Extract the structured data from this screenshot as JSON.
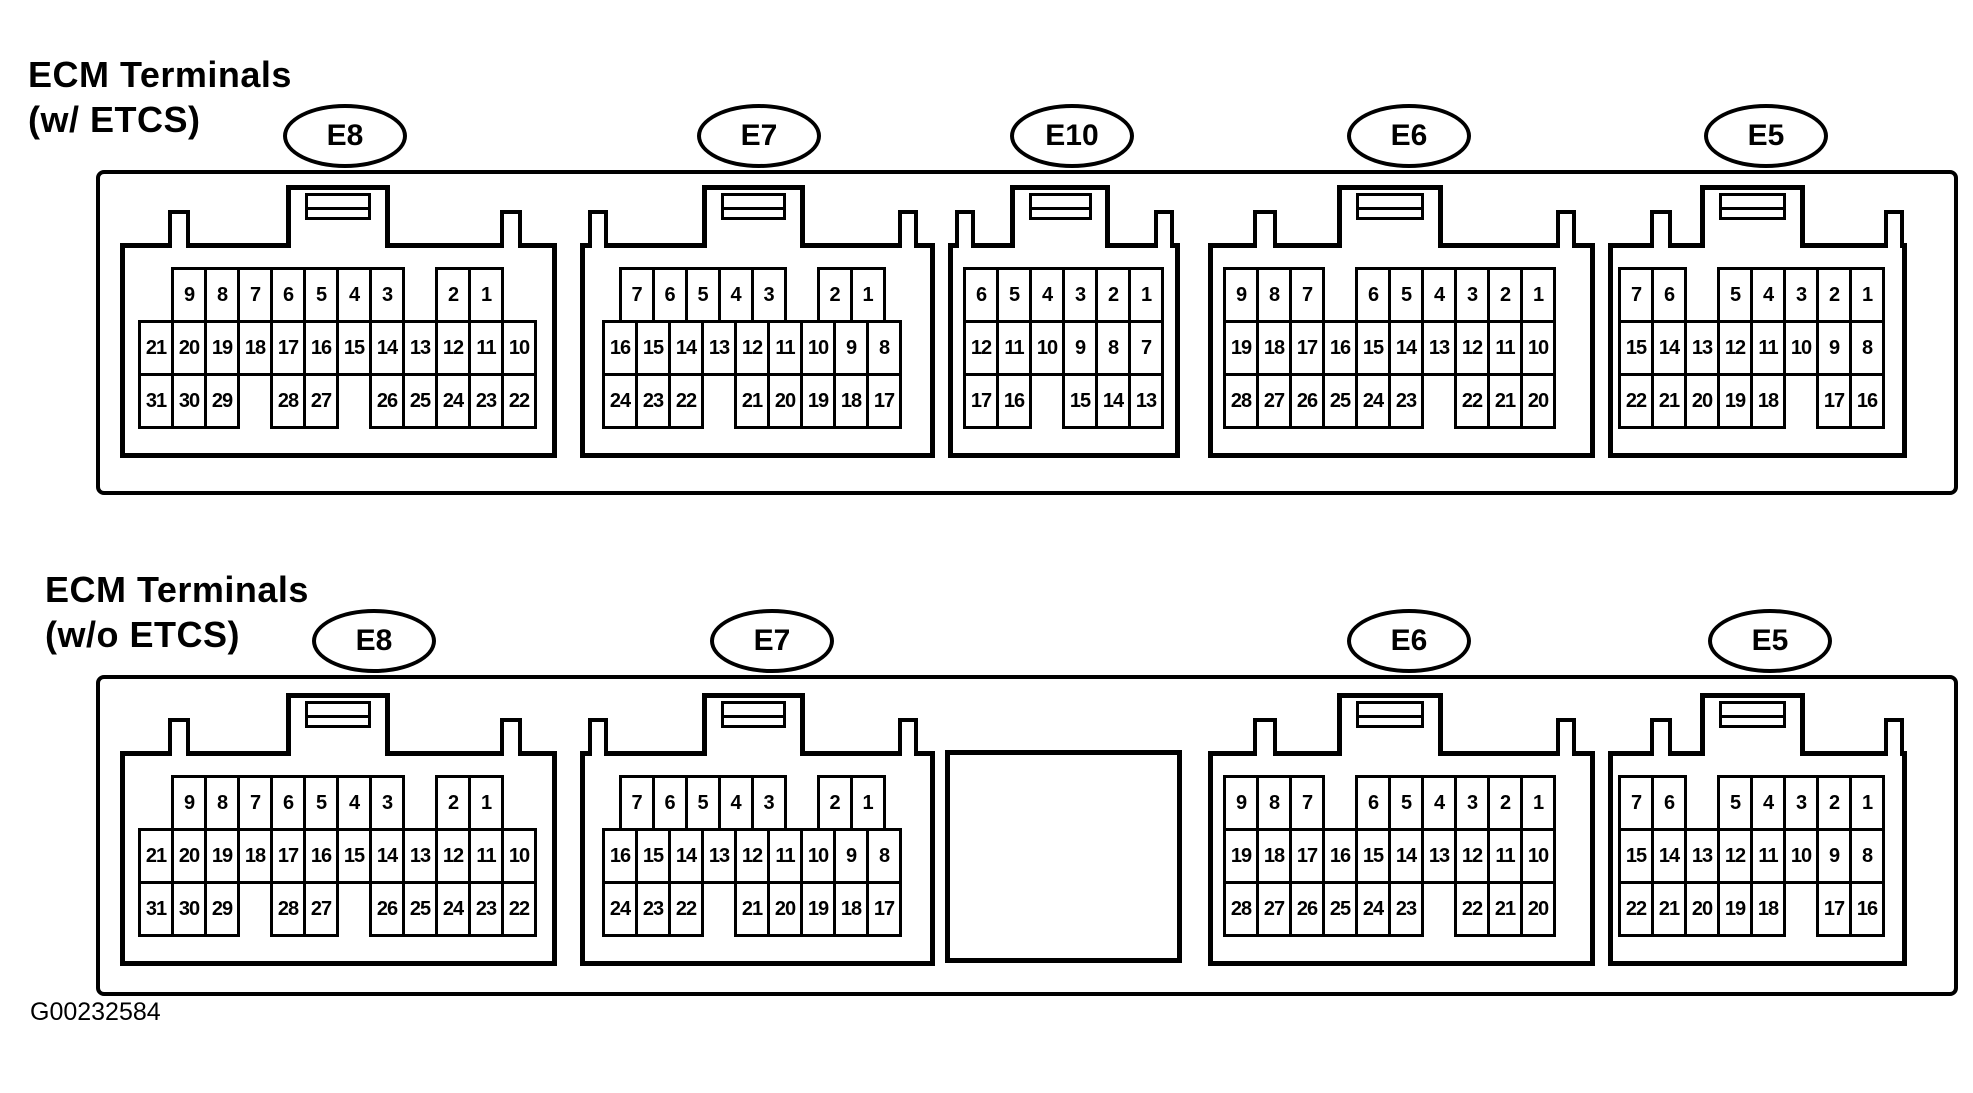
{
  "colors": {
    "ink": "#000000",
    "paper": "#ffffff"
  },
  "figure_id": "G00232584",
  "sections": [
    {
      "title_line1": "ECM Terminals",
      "title_line2": "(w/ ETCS)",
      "connectors": [
        {
          "label": "E8",
          "rows": [
            {
              "offset": 1,
              "cells": [
                "9",
                "8",
                "7",
                "6",
                "5",
                "4",
                "3",
                "",
                "2",
                "1"
              ]
            },
            {
              "offset": 0,
              "cells": [
                "21",
                "20",
                "19",
                "18",
                "17",
                "16",
                "15",
                "14",
                "13",
                "12",
                "11",
                "10"
              ]
            },
            {
              "offset": 0,
              "cells": [
                "31",
                "30",
                "29",
                "",
                "28",
                "27",
                "",
                "26",
                "25",
                "24",
                "23",
                "22"
              ]
            }
          ]
        },
        {
          "label": "E7",
          "rows": [
            {
              "offset": 0.5,
              "cells": [
                "7",
                "6",
                "5",
                "4",
                "3",
                "",
                "2",
                "1"
              ]
            },
            {
              "offset": 0,
              "cells": [
                "16",
                "15",
                "14",
                "13",
                "12",
                "11",
                "10",
                "9",
                "8"
              ]
            },
            {
              "offset": 0,
              "cells": [
                "24",
                "23",
                "22",
                "",
                "21",
                "20",
                "19",
                "18",
                "17"
              ]
            }
          ]
        },
        {
          "label": "E10",
          "rows": [
            {
              "offset": 0,
              "cells": [
                "6",
                "5",
                "4",
                "3",
                "2",
                "1"
              ]
            },
            {
              "offset": 0,
              "cells": [
                "12",
                "11",
                "10",
                "9",
                "8",
                "7"
              ]
            },
            {
              "offset": 0,
              "cells": [
                "17",
                "16",
                "",
                "15",
                "14",
                "13"
              ]
            }
          ]
        },
        {
          "label": "E6",
          "rows": [
            {
              "offset": 0,
              "cells": [
                "9",
                "8",
                "7",
                "",
                "6",
                "5",
                "4",
                "3",
                "2",
                "1"
              ]
            },
            {
              "offset": 0,
              "cells": [
                "19",
                "18",
                "17",
                "16",
                "15",
                "14",
                "13",
                "12",
                "11",
                "10"
              ]
            },
            {
              "offset": 0,
              "cells": [
                "28",
                "27",
                "26",
                "25",
                "24",
                "23",
                "",
                "22",
                "21",
                "20"
              ]
            }
          ]
        },
        {
          "label": "E5",
          "rows": [
            {
              "offset": 0,
              "cells": [
                "7",
                "6",
                "",
                "5",
                "4",
                "3",
                "2",
                "1"
              ]
            },
            {
              "offset": 0,
              "cells": [
                "15",
                "14",
                "13",
                "12",
                "11",
                "10",
                "9",
                "8"
              ]
            },
            {
              "offset": 0,
              "cells": [
                "22",
                "21",
                "20",
                "19",
                "18",
                "",
                "17",
                "16"
              ]
            }
          ]
        }
      ]
    },
    {
      "title_line1": "ECM Terminals",
      "title_line2": "(w/o ETCS)",
      "connectors": [
        {
          "label": "E8",
          "rows": [
            {
              "offset": 1,
              "cells": [
                "9",
                "8",
                "7",
                "6",
                "5",
                "4",
                "3",
                "",
                "2",
                "1"
              ]
            },
            {
              "offset": 0,
              "cells": [
                "21",
                "20",
                "19",
                "18",
                "17",
                "16",
                "15",
                "14",
                "13",
                "12",
                "11",
                "10"
              ]
            },
            {
              "offset": 0,
              "cells": [
                "31",
                "30",
                "29",
                "",
                "28",
                "27",
                "",
                "26",
                "25",
                "24",
                "23",
                "22"
              ]
            }
          ]
        },
        {
          "label": "E7",
          "rows": [
            {
              "offset": 0.5,
              "cells": [
                "7",
                "6",
                "5",
                "4",
                "3",
                "",
                "2",
                "1"
              ]
            },
            {
              "offset": 0,
              "cells": [
                "16",
                "15",
                "14",
                "13",
                "12",
                "11",
                "10",
                "9",
                "8"
              ]
            },
            {
              "offset": 0,
              "cells": [
                "24",
                "23",
                "22",
                "",
                "21",
                "20",
                "19",
                "18",
                "17"
              ]
            }
          ]
        },
        {
          "blank": true
        },
        {
          "label": "E6",
          "rows": [
            {
              "offset": 0,
              "cells": [
                "9",
                "8",
                "7",
                "",
                "6",
                "5",
                "4",
                "3",
                "2",
                "1"
              ]
            },
            {
              "offset": 0,
              "cells": [
                "19",
                "18",
                "17",
                "16",
                "15",
                "14",
                "13",
                "12",
                "11",
                "10"
              ]
            },
            {
              "offset": 0,
              "cells": [
                "28",
                "27",
                "26",
                "25",
                "24",
                "23",
                "",
                "22",
                "21",
                "20"
              ]
            }
          ]
        },
        {
          "label": "E5",
          "rows": [
            {
              "offset": 0,
              "cells": [
                "7",
                "6",
                "",
                "5",
                "4",
                "3",
                "2",
                "1"
              ]
            },
            {
              "offset": 0,
              "cells": [
                "15",
                "14",
                "13",
                "12",
                "11",
                "10",
                "9",
                "8"
              ]
            },
            {
              "offset": 0,
              "cells": [
                "22",
                "21",
                "20",
                "19",
                "18",
                "",
                "17",
                "16"
              ]
            }
          ]
        }
      ]
    }
  ]
}
